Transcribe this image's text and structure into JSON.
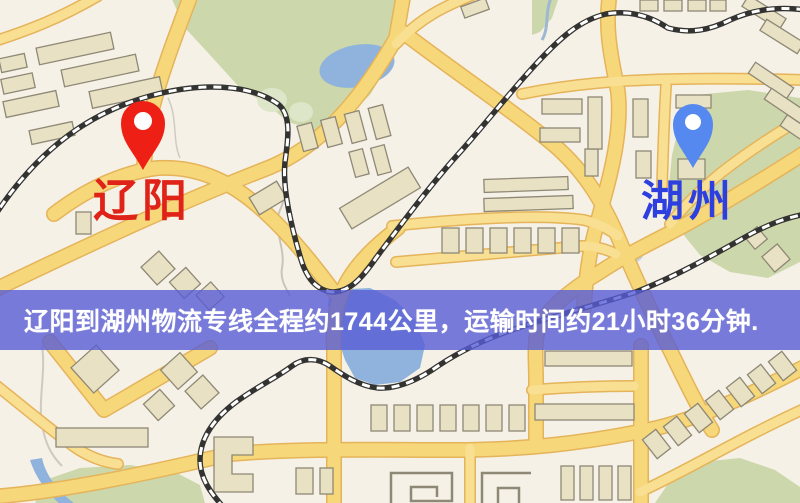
{
  "map": {
    "origin": {
      "name": "辽阳",
      "pin_icon": "map-pin-red",
      "pin_color": "#ee2015",
      "label_color": "#e02318"
    },
    "destination": {
      "name": "湖州",
      "pin_icon": "map-pin-blue",
      "pin_color": "#5589f0",
      "label_color": "#2e3fe0"
    },
    "banner": {
      "text": "辽阳到湖州物流专线全程约1744公里，运输时间约21小时36分钟.",
      "background_color": "#585cd6",
      "text_color": "#ffffff"
    },
    "route": {
      "distance_km": "1744",
      "duration": "21小时36分钟"
    },
    "legend_colors": {
      "background": "#f6f1e7",
      "road_fill": "#f6d77a",
      "road_border": "#e5b45a",
      "railway": "#333331",
      "water": "#8fb3dc",
      "park": "#ccd8ac",
      "building": "#e9e1c3"
    }
  }
}
